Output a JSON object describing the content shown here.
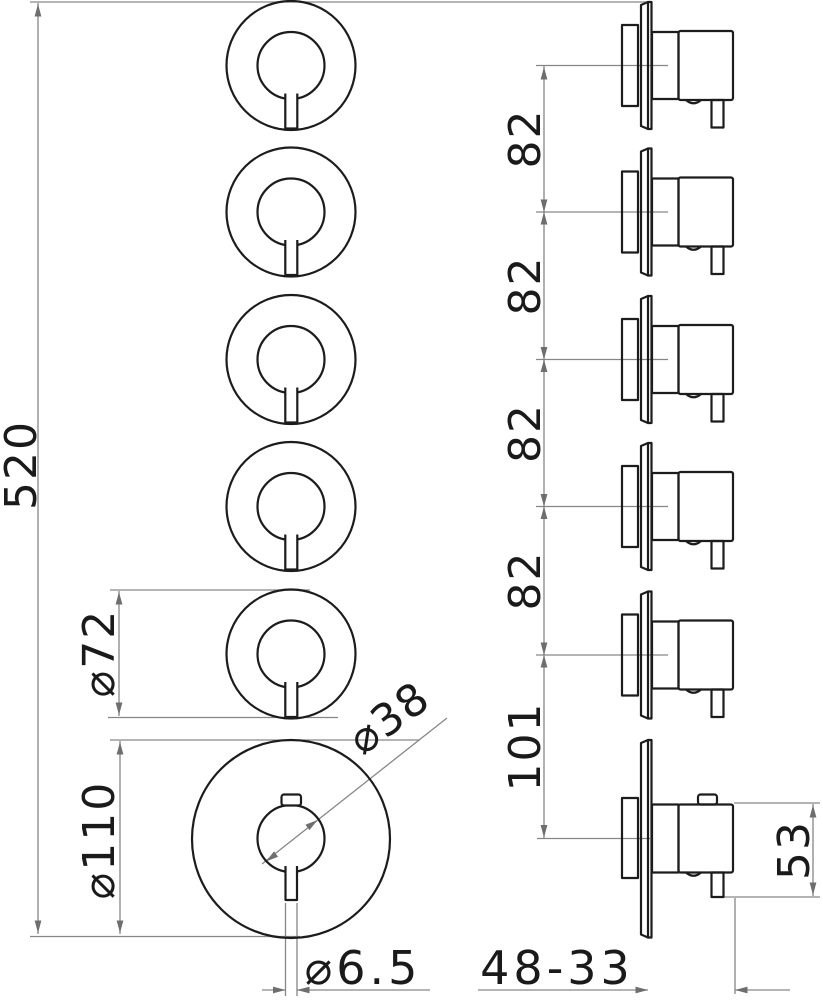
{
  "drawing": {
    "type": "technical-dimension-drawing",
    "views": {
      "front": "five small handles above one large thermostatic knob",
      "side": "six handle profiles mounted on wall plates"
    },
    "dims": {
      "overall_height": "520",
      "rosette_diameter": "⌀72",
      "base_plate_diameter": "⌀110",
      "grip_diameter": "⌀38",
      "pin_diameter": "⌀6.5",
      "projection_range": "48-33",
      "handle_projection": "53",
      "spacings": [
        "82",
        "82",
        "82",
        "82",
        "101"
      ]
    },
    "colors": {
      "object_line": "#1c1c1c",
      "dimension_line": "#868686",
      "arrow": "#6e6e6e",
      "text": "#1a1a1a",
      "background": "#ffffff"
    }
  }
}
